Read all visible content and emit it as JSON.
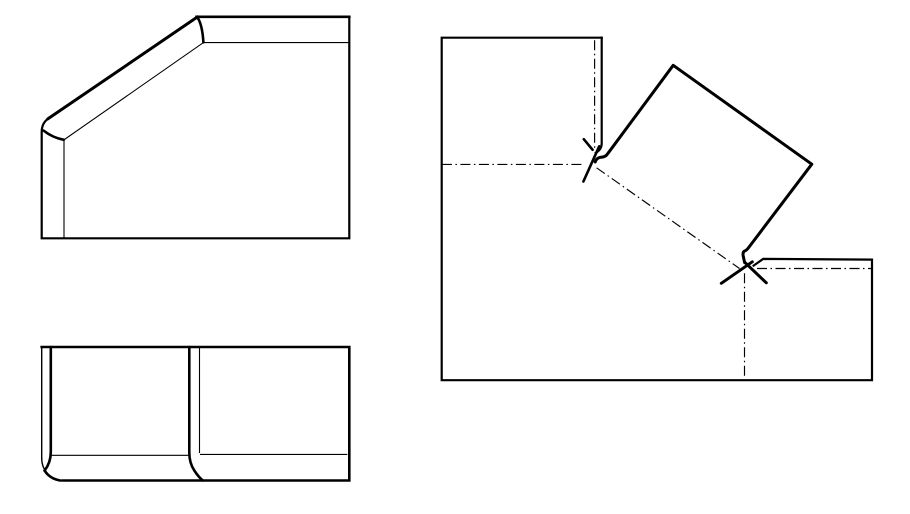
{
  "canvas": {
    "width": 910,
    "height": 514
  },
  "colors": {
    "background": "#ffffff",
    "lines": "#000000"
  },
  "views": {
    "front": {
      "outline": {
        "d": "M 349.3,16.8 L 349.3,238.3 L 41.7,238.3 L 41.7,131.8 Q 41.7,123.5 47.8,118.9"
      },
      "top_edge": {
        "d": "M 196.5,16.8 L 349.3,16.8"
      },
      "chamfer_edge": {
        "d": "M 47.8,118.9 L 197.7,16.8"
      },
      "bend_arc_top": {
        "d": "M 197.4,17.4 Q 202.3,24.5 203.4,42.3"
      },
      "bend_arc_bottom": {
        "d": "M 43.6,130.6 Q 52.5,137.6 63.8,139.8"
      },
      "inner_top_line": {
        "d": "M 203.4,42.6 L 348.2,42.6"
      },
      "inner_chamfer_line": {
        "d": "M 203.4,42.6 L 64,139.8"
      },
      "inner_left_line": {
        "d": "M 64,139.8 L 64,237.8"
      }
    },
    "top": {
      "outer": {
        "d": "M 41.7,347 L 349.3,347 L 349.3,480.5 L 62.5,480.5"
      },
      "left_edge": {
        "d": "M 41.7,347 L 41.7,458.5"
      },
      "corner_arc": {
        "d": "M 41.7,458.5 A 21,22 0 0 0 62.5,480.5"
      },
      "bend_line_left": {
        "d": "M 50.8,347 L 50.8,452 Q 50.8,462.5 44.6,470.6"
      },
      "bend_arc_corner": {
        "d": "M 44.6,470.6 Q 49.5,478.6 60,480.5"
      },
      "bend_curve_mid": {
        "d": "M 189.3,347 L 189.3,452.5 Q 189.3,463 194.3,470.5 Q 198.5,477 202.8,480.5"
      },
      "inner_vertical": {
        "d": "M 199.5,347 L 199.5,452.5"
      },
      "inner_horizontal_left": {
        "d": "M 51.9,455.3 L 188.2,455.3"
      },
      "inner_horizontal_right": {
        "d": "M 200.6,454.4 L 346.8,454.4"
      }
    },
    "flat": {
      "body_outline": {
        "d": "M 601.7,37.7 L 441.7,37.7 L 441.7,380.2 L 872,380.2 L 872,259.6 L 763.2,258.9 L 753.6,265.6"
      },
      "tab_right_edge": {
        "d": "M 601.7,37.7 L 601.7,143.5 Q 601.7,149.5 595.8,152.8"
      },
      "flange_outline": {
        "d": "M 595.2,162 Q 596.5,157.8 600.8,157.3 Q 605.5,157.2 607.7,153.7 L 673.2,65.3 L 811.8,164.2 L 748.6,247.6 Q 746.5,250.4 744.7,250.9 Q 742.6,252 743.1,255.4 L 744.6,262.6"
      },
      "bend1_slash": {
        "d": "M 583.4,181.5 L 599.2,146.3"
      },
      "bend1_tick": {
        "d": "M 583.8,139.2 L 592.6,149.8"
      },
      "bend2_slash": {
        "d": "M 721.3,283.3 L 752.3,261.8"
      },
      "bend2_tick": {
        "d": "M 745.3,262.8 L 766.3,282.8"
      },
      "bendline_h1": {
        "d": "M 441.9,164.4 L 584.5,164.4"
      },
      "bendline_v1": {
        "d": "M 594.6,40.3 L 594.6,149.6"
      },
      "bendline_diag": {
        "d": "M 596.6,167.8 L 739.5,268.5"
      },
      "bendline_h2": {
        "d": "M 757,268.5 L 871.2,268.5"
      },
      "bendline_v2": {
        "d": "M 744.5,273.3 L 744.5,378.3"
      }
    }
  }
}
